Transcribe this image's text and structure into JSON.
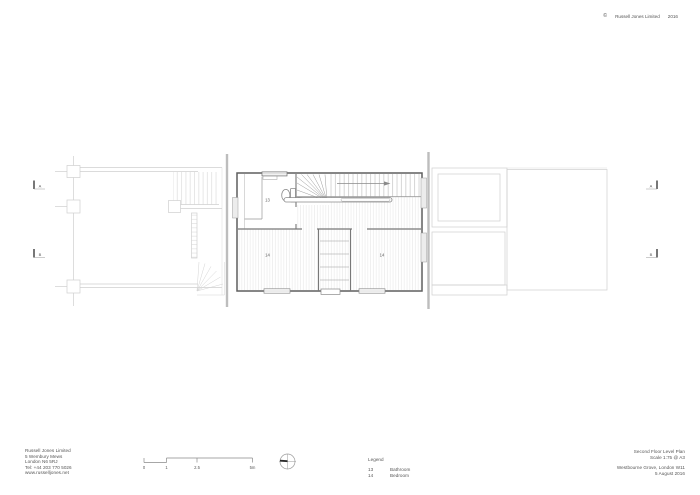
{
  "copyright": {
    "symbol": "©",
    "name": "Russell Jones Limited",
    "year": "2016"
  },
  "firm": {
    "lines": [
      "Russell Jones Limited",
      "5 Wembury Mews",
      "London N6 5RJ",
      "Tel: +44 203 770 5026",
      "www.russelljones.net"
    ]
  },
  "title_block": {
    "title": "Second Floor Level Plan",
    "scale": "Scale 1:75 @ A3",
    "project": "Westbourne Grove, London W11",
    "date": "5 August 2016"
  },
  "legend": {
    "heading": "Legend",
    "items": [
      {
        "number": "13",
        "label": "Bathroom"
      },
      {
        "number": "14",
        "label": "Bedroom"
      }
    ]
  },
  "scale_bar": {
    "labels": [
      "0",
      "1",
      "2.5",
      "5m"
    ]
  },
  "plan": {
    "rooms": {
      "bathroom": "13",
      "bedroom_left": "14",
      "bedroom_right": "14"
    },
    "sections": {
      "a": "A",
      "b": "B"
    }
  }
}
